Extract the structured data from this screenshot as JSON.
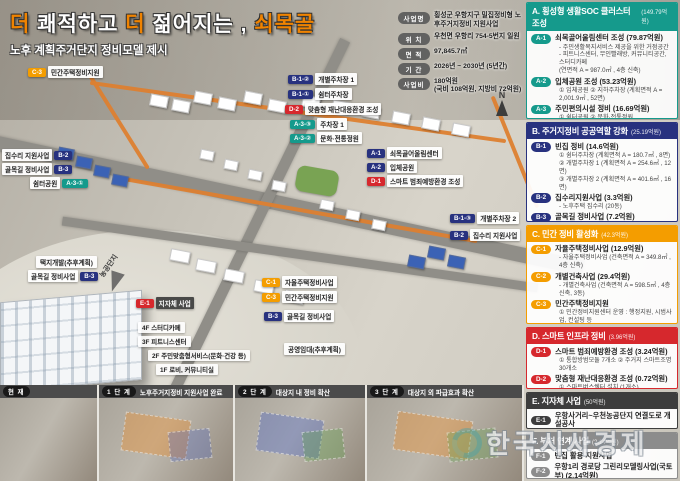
{
  "title": {
    "t1": "더",
    "t2": "쾌적하고",
    "t3": "더",
    "t4": "젊어지는 ,",
    "t5": "쇠목골",
    "subtitle": "노후 계획주거단지 정비모델 제시"
  },
  "info_table": {
    "rows": [
      {
        "label": "사업명",
        "value": "횡성군 우항지구 밀집정비형 노후주거지정비 지원사업"
      },
      {
        "label": "위 치",
        "value": "우천면 우항리 754-5번지 일원"
      },
      {
        "label": "면 적",
        "value": "97,845.7㎡"
      },
      {
        "label": "기 간",
        "value": "2026년 ~ 2030년 (5년간)"
      },
      {
        "label": "사업비",
        "value": "180억원",
        "value2": "(국비 108억원, 지방비 72억원)"
      }
    ]
  },
  "colors": {
    "teal": "#159a8c",
    "navy": "#28327f",
    "yellow": "#f49d00",
    "red": "#d6282d",
    "dark": "#3d3d3d",
    "gray": "#8c8c8c",
    "accent_orange": "#f08300"
  },
  "sidebar": {
    "sections": [
      {
        "code": "A",
        "title": "A. 횡성형 생활SOC 클러스터 조성",
        "budget": "(149.79억원)",
        "color": "#159a8c",
        "items": [
          {
            "badge": "A-1",
            "title": "쇠목골어울림센터 조성 (79.87억원)",
            "subs": [
              "- 주민생활복지서비스 제공을 위한 거점공간",
              "- 피트니스센터, 무인빨래방, 커뮤니티공간, 스터디카페",
              "(연면적 A = 987.0㎡ , 4층 신축)"
            ]
          },
          {
            "badge": "A-2",
            "title": "입체공원 조성 (53.23억원)",
            "subs": [
              "① 입체공원  ② 지하주차장 (계획면적 A = 2,001.9㎡ , 52면)"
            ]
          },
          {
            "badge": "A-3",
            "title": "주민편의시설 정비 (16.69억원)",
            "subs": [
              "① 쉼터공원  ② 문화·전통정원",
              "③ 주차장 1 (계획면적 A = 649.0㎡ , 30면)"
            ]
          }
        ]
      },
      {
        "code": "B",
        "title": "B. 주거지정비 공공역할 강화",
        "budget": "(25.19억원)",
        "color": "#28327f",
        "items": [
          {
            "badge": "B-1",
            "title": "빈집 정비 (14.6억원)",
            "subs": [
              "① 쉼터주차장 (계획면적 A = 180.7㎡ , 8면)",
              "② 개별주차장 1 (계획면적 A = 254.6㎡ , 12면)",
              "③ 개별주차장 2 (계획면적 A = 401.6㎡ , 16면)"
            ]
          },
          {
            "badge": "B-2",
            "title": "집수리지원사업 (3.3억원)",
            "subs": [
              "- 노후주택 집수리 (20동)"
            ]
          },
          {
            "badge": "B-3",
            "title": "골목길 정비사업 (7.2억원)",
            "subs": [
              "- 거주구역별 특색있는 경관 조성 (3개 구역)"
            ]
          }
        ]
      },
      {
        "code": "C",
        "title": "C. 민간 정비 활성화",
        "budget": "(42.3억원)",
        "color": "#f49d00",
        "items": [
          {
            "badge": "C-1",
            "title": "자율주택정비사업 (12.9억원)",
            "subs": [
              "- 자율주택정비사업 (건축면적 A = 349.8㎡ , 4층 신축)"
            ]
          },
          {
            "badge": "C-2",
            "title": "개별건축사업 (29.4억원)",
            "subs": [
              "- 개별건축사업 (건축면적 A = 598.5㎡ , 4층 신축, 3동)"
            ]
          },
          {
            "badge": "C-3",
            "title": "민간주택정비지원",
            "subs": [
              "① 민간정비지원센터 운영 : 행정지원, 시범사업, 컨설팅 등",
              "② 개별재건축 5동 : 개별재건축 컨설팅 지원"
            ]
          }
        ]
      },
      {
        "code": "D",
        "title": "D. 스마트 인프라 정비",
        "budget": "(3.96억원)",
        "color": "#d6282d",
        "items": [
          {
            "badge": "D-1",
            "title": "스마트 범죄예방환경 조성 (3.24억원)",
            "subs": [
              "① 통합방범모듈 7개소  ② 주거지 스마트조명 30개소"
            ]
          },
          {
            "badge": "D-2",
            "title": "맞춤형 재난대응환경 조성 (0.72억원)",
            "subs": [
              "① 스마트버스쉘터 설치 (1개소)"
            ]
          }
        ]
      },
      {
        "code": "E",
        "title": "E. 지자체 사업",
        "budget": "(50억원)",
        "color": "#3d3d3d",
        "items": [
          {
            "badge": "E-1",
            "title": "우항사거리~우천농공단지 연결도로 개설공사",
            "subs": []
          }
        ]
      },
      {
        "code": "F",
        "title": "F. 부처 연계 사업",
        "budget": "(2.14억원)",
        "color": "#8c8c8c",
        "items": [
          {
            "badge": "F-1",
            "title": "빈집 활용 지원사업",
            "subs": []
          },
          {
            "badge": "F-2",
            "title": "우항1리 경로당 그린리모델링사업(국토부) (2.14억원)",
            "subs": []
          }
        ]
      }
    ]
  },
  "map": {
    "labels": [
      {
        "badge": "C-3",
        "text": "민간주택정비지원",
        "c": "yellow",
        "x": 28,
        "y": 66,
        "side": "left"
      },
      {
        "badge": "B-1-②",
        "text": "개별주차장 1",
        "c": "navy",
        "x": 288,
        "y": 73,
        "side": "left"
      },
      {
        "badge": "B-1-①",
        "text": "쉼터주차장",
        "c": "navy",
        "x": 288,
        "y": 88,
        "side": "left"
      },
      {
        "badge": "D-2",
        "text": "맞춤형 재난대응환경 조성",
        "c": "red",
        "x": 285,
        "y": 103,
        "side": "left"
      },
      {
        "badge": "A-3-③",
        "text": "주차장 1",
        "c": "teal",
        "x": 290,
        "y": 118,
        "side": "left"
      },
      {
        "badge": "A-3-②",
        "text": "문화·전통정원",
        "c": "teal",
        "x": 290,
        "y": 132,
        "side": "left"
      },
      {
        "badge": "A-1",
        "text": "쇠목골어울림센터",
        "c": "navy",
        "x": 367,
        "y": 147,
        "side": "left"
      },
      {
        "badge": "A-2",
        "text": "입체공원",
        "c": "navy",
        "x": 367,
        "y": 161,
        "side": "left"
      },
      {
        "badge": "D-1",
        "text": "스마트 범죄예방환경 조성",
        "c": "red",
        "x": 367,
        "y": 175,
        "side": "left"
      },
      {
        "badge": "B-1-③",
        "text": "개별주차장 2",
        "c": "navy",
        "x": 450,
        "y": 212,
        "side": "left"
      },
      {
        "badge": "B-2",
        "text": "집수리 지원사업",
        "c": "navy",
        "x": 450,
        "y": 229,
        "side": "left"
      },
      {
        "badge": "B-2",
        "text": "집수리 지원사업",
        "c": "navy",
        "x": 2,
        "y": 149,
        "side": "right"
      },
      {
        "badge": "B-3",
        "text": "골목길 정비사업",
        "c": "navy",
        "x": 2,
        "y": 163,
        "side": "right"
      },
      {
        "badge": "A-3-①",
        "text": "쉼터공원",
        "c": "teal",
        "x": 30,
        "y": 177,
        "side": "right"
      },
      {
        "badge": "B-3",
        "text": "골목길 정비사업",
        "c": "navy",
        "x": 28,
        "y": 270,
        "side": "right"
      },
      {
        "badge": "E-1",
        "text": "지자체 사업",
        "c": "red",
        "x": 136,
        "y": 297,
        "side": "left",
        "dark": true
      },
      {
        "badge": "C-1",
        "text": "자율주택정비사업",
        "c": "yellow",
        "x": 262,
        "y": 276,
        "side": "left"
      },
      {
        "badge": "C-3",
        "text": "민간주택정비지원",
        "c": "yellow",
        "x": 262,
        "y": 291,
        "side": "left"
      },
      {
        "badge": "B-3",
        "text": "골목길 정비사업",
        "c": "navy",
        "x": 264,
        "y": 310,
        "side": "left"
      }
    ],
    "plain_labels": [
      {
        "text": "택지개발(추후계획)",
        "x": 36,
        "y": 256
      },
      {
        "text": "공영임대(추후계획)",
        "x": 284,
        "y": 343
      },
      {
        "text": "농공단지",
        "x": 92,
        "y": 260,
        "rotate": -55
      }
    ],
    "callout": {
      "x": 138,
      "y": 322,
      "lines": [
        "4F 스터디카페",
        "3F 피트니스센터",
        "2F 주민맞춤형서비스(문화·건강 등)",
        "1F 로비, 커뮤니티실"
      ]
    },
    "compass": "N"
  },
  "timeline": {
    "panels": [
      {
        "badge": "현 재",
        "desc": "",
        "w": 99
      },
      {
        "badge": "1 단 계",
        "desc": "노후주거지정비 지원사업 완료",
        "w": 136
      },
      {
        "badge": "2 단 계",
        "desc": "대상지 내 정비 확산",
        "w": 132
      },
      {
        "badge": "3 단 계",
        "desc": "대상지 외 파급효과 확산",
        "w": 157
      }
    ]
  },
  "watermark": "한국시사경제"
}
